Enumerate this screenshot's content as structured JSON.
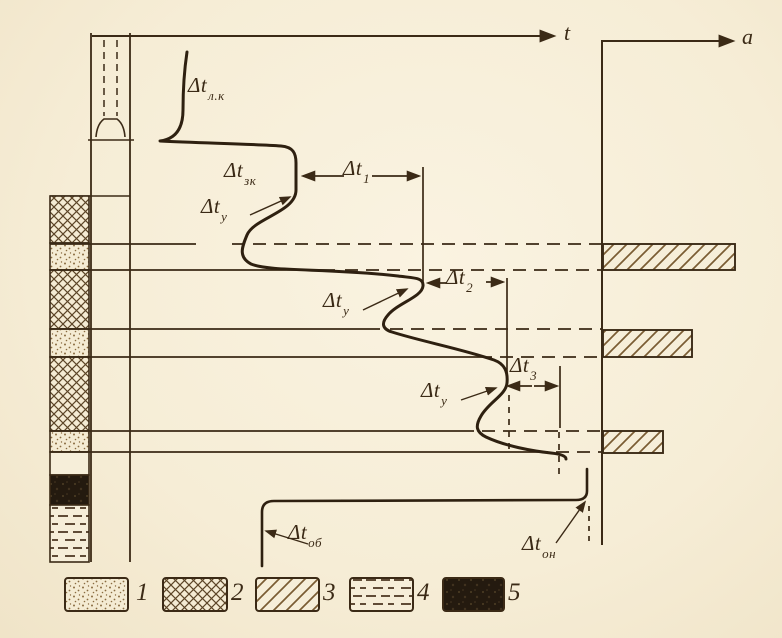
{
  "figure": {
    "kind": "well thermogram with flow-profile diagram (scanned book figure)",
    "paper_color": "#f6edd6",
    "ink_color": "#3b2a16",
    "hatch_color": "#7a5c33"
  },
  "axes": {
    "temperature_axis_label": "t",
    "flow_axis_label": "a"
  },
  "labels": {
    "dt_lk": {
      "main": "Δt",
      "sub": "л.к"
    },
    "dt_zk": {
      "main": "Δt",
      "sub": "зк"
    },
    "dt_u1": {
      "main": "Δt",
      "sub": "у"
    },
    "dt_1": {
      "main": "Δt",
      "sub": "1"
    },
    "dt_u2": {
      "main": "Δt",
      "sub": "у"
    },
    "dt_2": {
      "main": "Δt",
      "sub": "2"
    },
    "dt_u3": {
      "main": "Δt",
      "sub": "у"
    },
    "dt_3": {
      "main": "Δt",
      "sub": "3"
    },
    "dt_ob": {
      "main": "Δt",
      "sub": "об"
    },
    "dt_on": {
      "main": "Δt",
      "sub": "он"
    }
  },
  "legend": {
    "items": [
      {
        "number": "1",
        "pattern": "dotted"
      },
      {
        "number": "2",
        "pattern": "crosshatch"
      },
      {
        "number": "3",
        "pattern": "diagonal-hatch"
      },
      {
        "number": "4",
        "pattern": "horizontal-dashes"
      },
      {
        "number": "5",
        "pattern": "solid-black"
      }
    ]
  },
  "lithology_column": {
    "layers_top_to_bottom": [
      "crosshatch",
      "dotted",
      "crosshatch",
      "dotted",
      "crosshatch",
      "dotted",
      "blank",
      "solid-black",
      "horizontal-dashes"
    ]
  },
  "flow_bars": {
    "count": 3,
    "relative_lengths": [
      1.0,
      0.67,
      0.45
    ],
    "note": "hatched inflow bars at three perforated dotted layers, length decreasing with depth"
  }
}
